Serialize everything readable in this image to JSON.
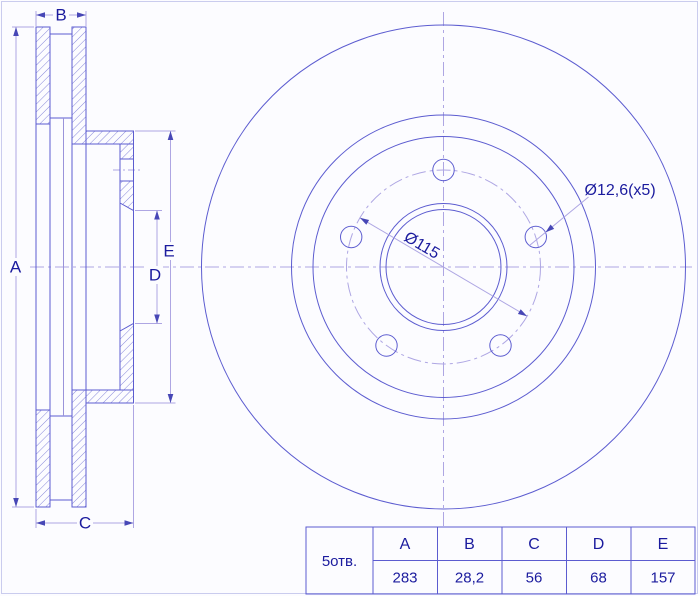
{
  "labels": {
    "a": "A",
    "b": "B",
    "c": "C",
    "d": "D",
    "e": "E"
  },
  "annotations": {
    "bolt_circle": "Ø115",
    "bolt_holes": "Ø12,6(x5)"
  },
  "table": {
    "row_label": "5отв.",
    "headers": [
      "A",
      "B",
      "C",
      "D",
      "E"
    ],
    "values": [
      "283",
      "28,2",
      "56",
      "68",
      "157"
    ]
  },
  "colors": {
    "main_line": "#5c5cd0",
    "dim_line": "#aea6e3",
    "text": "#1b1b9e",
    "hatch": "#8787da",
    "frame": "#caccee"
  }
}
